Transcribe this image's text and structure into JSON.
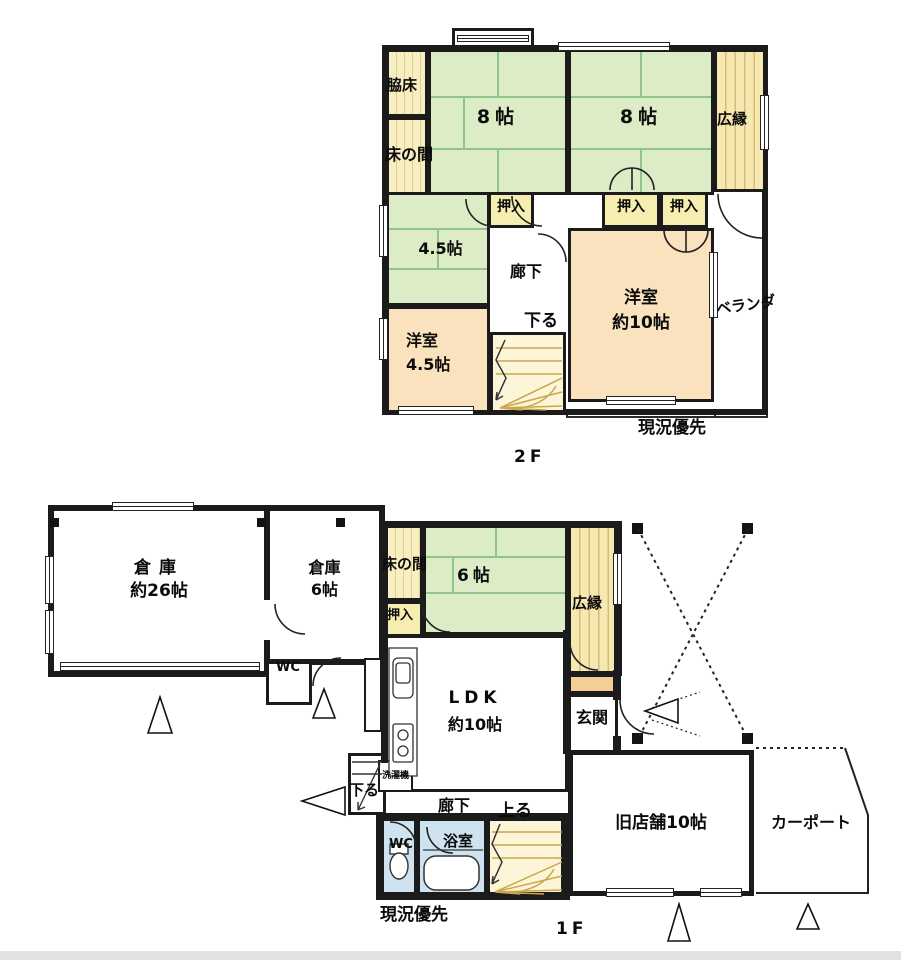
{
  "colors": {
    "wall": "#1b1b1b",
    "tatami": "#dcecc6",
    "tatami_line": "#8fc48a",
    "engawa": "#f5e8b0",
    "engawa_line": "#d9bd77",
    "tokonoma": "#f7efc2",
    "oshiire": "#f6eeb0",
    "western_room": "#f9e2bd",
    "entry_step": "#f3cf97",
    "stairs": "#fdf5d8",
    "stair_line": "#c9a84c",
    "wet_area": "#cfe2f0"
  },
  "f2": {
    "floor_label": "2F",
    "note": "現況優先",
    "rooms": {
      "wakidoko": "脇床",
      "tokonoma": "床の間",
      "tatami8_left": "8帖",
      "tatami8_right": "8帖",
      "hiroen": "広縁",
      "oshiire_1": "押入",
      "oshiire_2": "押入",
      "oshiire_3": "押入",
      "tatami45": "4.5帖",
      "rouka": "廊下",
      "stairs_down": "下る",
      "yoshitsu10_line1": "洋室",
      "yoshitsu10_line2": "約10帖",
      "yoshitsu45_line1": "洋室",
      "yoshitsu45_line2": "4.5帖",
      "veranda": "ベランダ"
    }
  },
  "f1": {
    "floor_label": "1F",
    "note": "現況優先",
    "rooms": {
      "souko26_line1": "倉庫",
      "souko26_line2": "約26帖",
      "souko6_line1": "倉庫",
      "souko6_line2": "6帖",
      "wc_souko": "WC",
      "tokonoma": "床の間",
      "tatami6": "6帖",
      "oshiire": "押入",
      "hiroen": "広縁",
      "ldk_line1": "LDK",
      "ldk_line2": "約10帖",
      "genkan": "玄関",
      "sentakuki": "洗濯機",
      "stairs_down": "下る",
      "rouka": "廊下",
      "stairs_up": "上る",
      "wc": "WC",
      "yokushitsu": "浴室",
      "kyu_tempo": "旧店舗10帖",
      "carport": "カーポート"
    }
  }
}
